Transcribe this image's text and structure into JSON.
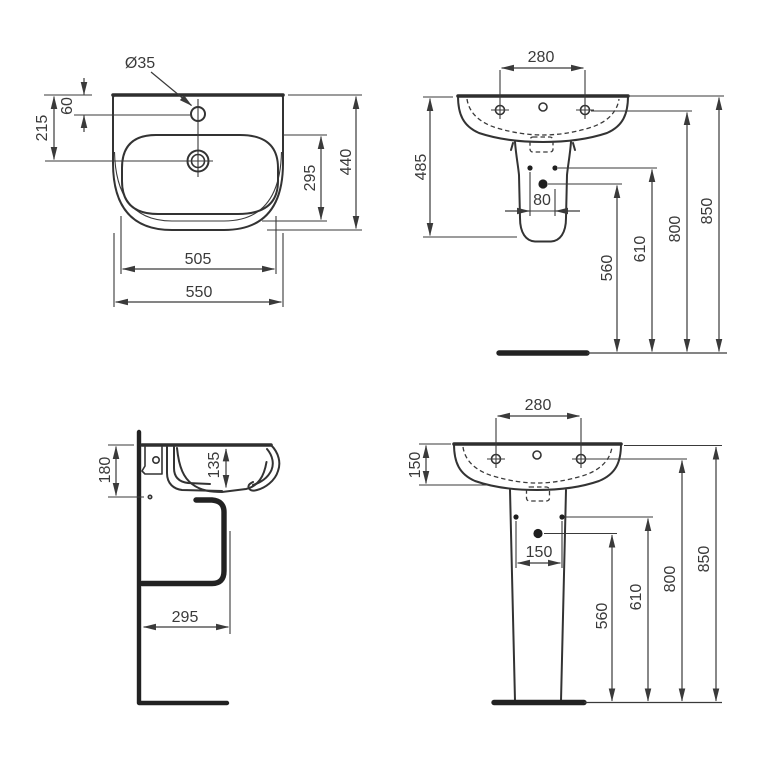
{
  "colors": {
    "line": "#333333",
    "text": "#3a3a3a",
    "dot_fill": "#1f1f1f",
    "background": "#ffffff"
  },
  "views": {
    "plan": {
      "title": "basin-plan-view",
      "dims": {
        "tap_hole_diameter": "Ø35",
        "tap_hole_offset": "60",
        "drain_offset": "215",
        "bowl_depth": "295",
        "overall_depth": "440",
        "bowl_width": "505",
        "overall_width": "550"
      }
    },
    "front_semi": {
      "title": "front-view-semi-pedestal",
      "dims": {
        "fixing_hole_centres": "280",
        "height_with_semi_pedestal": "485",
        "fixing_bolt_spacing": "80",
        "trap_outlet_height": "560",
        "water_inlet_height": "610",
        "fixing_hole_height": "800",
        "rim_height": "850"
      }
    },
    "side": {
      "title": "side-section-view",
      "dims": {
        "fixing_drop_from_rim": "180",
        "bowl_inner_depth": "135",
        "waste_outlet_from_wall": "295"
      }
    },
    "front_full": {
      "title": "front-view-full-pedestal",
      "dims": {
        "fixing_hole_centres": "280",
        "rim_to_overflow_drop": "150",
        "fixing_bolt_spacing": "150",
        "trap_outlet_height": "560",
        "water_inlet_height": "610",
        "fixing_hole_height": "800",
        "rim_height": "850"
      }
    }
  }
}
